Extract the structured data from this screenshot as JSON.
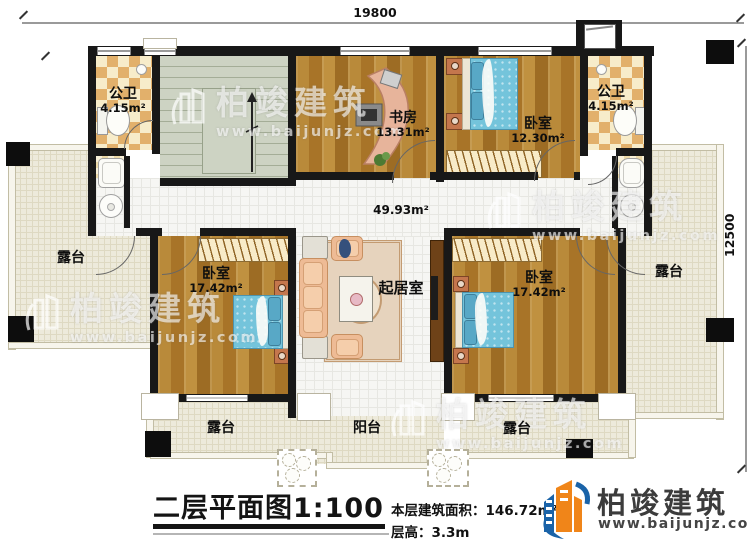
{
  "dimensions": {
    "top": "19800",
    "right": "12500"
  },
  "rooms": {
    "bath_left": {
      "name": "公卫",
      "area": "4.15m²"
    },
    "study": {
      "name": "书房",
      "area": "13.31m²"
    },
    "bedroom_top": {
      "name": "卧室",
      "area": "12.30m²"
    },
    "bath_right": {
      "name": "公卫",
      "area": "4.15m²"
    },
    "hall": {
      "area": "49.93m²"
    },
    "bedroom_left": {
      "name": "卧室",
      "area": "17.42m²"
    },
    "living": {
      "name": "起居室"
    },
    "bedroom_right": {
      "name": "卧室",
      "area": "17.42m²"
    },
    "terrace_left": {
      "name": "露台"
    },
    "terrace_right": {
      "name": "露台"
    },
    "terrace_bottom_left": {
      "name": "露台"
    },
    "balcony": {
      "name": "阳台"
    },
    "terrace_bottom_right": {
      "name": "露台"
    }
  },
  "titleblock": {
    "title": "二层平面图1:100",
    "area_label": "本层建筑面积：",
    "area_value": "146.72m²",
    "height_label": "层高：",
    "height_value": "3.3m"
  },
  "brand": {
    "name": "柏竣建筑",
    "website": "www.baijunjz.com"
  },
  "watermark": {
    "name": "柏竣建筑",
    "website": "www.baijunjz.com"
  },
  "colors": {
    "wall": "#181818",
    "brand_blue": "#1a63a8",
    "brand_orange": "#f08519"
  }
}
